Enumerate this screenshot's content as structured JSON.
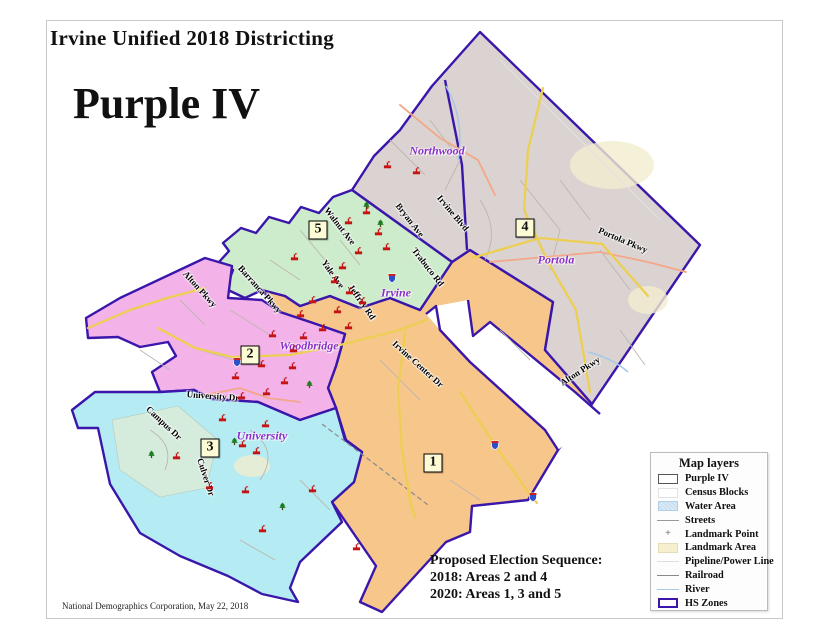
{
  "page": {
    "title": "Irvine Unified 2018 Districting",
    "map_name": "Purple IV",
    "footer": "National Demographics Corporation, May 22, 2018"
  },
  "election_sequence": {
    "heading": "Proposed Election Sequence:",
    "line1": "2018: Areas 2 and 4",
    "line2": "2020: Areas 1, 3 and 5"
  },
  "legend": {
    "title": "Map layers",
    "items": [
      {
        "label": "Purple IV",
        "swatch": "district-outline"
      },
      {
        "label": "Census Blocks",
        "swatch": "census-box"
      },
      {
        "label": "Water Area",
        "swatch": "water-box"
      },
      {
        "label": "Streets",
        "swatch": "street-line"
      },
      {
        "label": "Landmark Point",
        "swatch": "landmark-point",
        "symbol": "+"
      },
      {
        "label": "Landmark Area",
        "swatch": "landmark-box"
      },
      {
        "label": "Pipeline/Power Line",
        "swatch": "pipeline-line"
      },
      {
        "label": "Railroad",
        "swatch": "railroad-line"
      },
      {
        "label": "River",
        "swatch": "river-line"
      },
      {
        "label": "HS Zones",
        "swatch": "hszone-outline"
      }
    ]
  },
  "districts": {
    "area1": {
      "number": "1",
      "color": "#f7c68b",
      "badge": {
        "x": 433,
        "y": 463
      }
    },
    "area2": {
      "number": "2",
      "color": "#f3b3e9",
      "badge": {
        "x": 250,
        "y": 355
      }
    },
    "area3": {
      "number": "3",
      "color": "#b5ebf3",
      "badge": {
        "x": 210,
        "y": 448
      }
    },
    "area4": {
      "number": "4",
      "color": "#dbd3d1",
      "badge": {
        "x": 525,
        "y": 228
      }
    },
    "area5": {
      "number": "5",
      "color": "#cdeccb",
      "badge": {
        "x": 318,
        "y": 230
      }
    }
  },
  "place_labels": [
    {
      "text": "Northwood",
      "x": 437,
      "y": 151
    },
    {
      "text": "Portola",
      "x": 556,
      "y": 260
    },
    {
      "text": "Irvine",
      "x": 396,
      "y": 293
    },
    {
      "text": "Woodbridge",
      "x": 309,
      "y": 346
    },
    {
      "text": "University",
      "x": 262,
      "y": 436
    }
  ],
  "street_labels": [
    {
      "text": "Bryan Ave",
      "x": 410,
      "y": 220,
      "rot": 52
    },
    {
      "text": "Irvine Blvd",
      "x": 453,
      "y": 213,
      "rot": 50
    },
    {
      "text": "Trabuco Rd",
      "x": 428,
      "y": 267,
      "rot": 52
    },
    {
      "text": "Portola Pkwy",
      "x": 623,
      "y": 240,
      "rot": 23
    },
    {
      "text": "Walnut Ave",
      "x": 340,
      "y": 226,
      "rot": 52
    },
    {
      "text": "Yale Ave",
      "x": 333,
      "y": 274,
      "rot": 55
    },
    {
      "text": "Jeffrey Rd",
      "x": 362,
      "y": 302,
      "rot": 55
    },
    {
      "text": "Barranca Pkwy",
      "x": 260,
      "y": 289,
      "rot": 48
    },
    {
      "text": "Alton Pkwy",
      "x": 200,
      "y": 289,
      "rot": 48
    },
    {
      "text": "Alton Pkwy",
      "x": 580,
      "y": 371,
      "rot": -33
    },
    {
      "text": "University Dr",
      "x": 213,
      "y": 396,
      "rot": 4
    },
    {
      "text": "Campus Dr",
      "x": 164,
      "y": 423,
      "rot": 43
    },
    {
      "text": "Culver Dr",
      "x": 206,
      "y": 477,
      "rot": 72
    },
    {
      "text": "Irvine Center Dr",
      "x": 418,
      "y": 364,
      "rot": 42
    }
  ],
  "map_icons": {
    "schools": [
      [
        383,
        160
      ],
      [
        412,
        166
      ],
      [
        362,
        206
      ],
      [
        344,
        216
      ],
      [
        374,
        227
      ],
      [
        382,
        242
      ],
      [
        354,
        246
      ],
      [
        290,
        252
      ],
      [
        338,
        261
      ],
      [
        330,
        275
      ],
      [
        345,
        286
      ],
      [
        308,
        295
      ],
      [
        358,
        296
      ],
      [
        333,
        305
      ],
      [
        296,
        309
      ],
      [
        318,
        323
      ],
      [
        344,
        321
      ],
      [
        268,
        329
      ],
      [
        299,
        331
      ],
      [
        289,
        344
      ],
      [
        257,
        359
      ],
      [
        288,
        361
      ],
      [
        231,
        371
      ],
      [
        280,
        376
      ],
      [
        262,
        387
      ],
      [
        237,
        391
      ],
      [
        218,
        413
      ],
      [
        261,
        419
      ],
      [
        238,
        439
      ],
      [
        252,
        446
      ],
      [
        172,
        451
      ],
      [
        205,
        481
      ],
      [
        241,
        485
      ],
      [
        258,
        524
      ],
      [
        352,
        542
      ],
      [
        308,
        484
      ]
    ],
    "trees": [
      [
        362,
        201
      ],
      [
        376,
        219
      ],
      [
        305,
        380
      ],
      [
        147,
        450
      ],
      [
        278,
        502
      ],
      [
        230,
        437
      ]
    ],
    "shields": [
      [
        387,
        273
      ],
      [
        232,
        357
      ],
      [
        490,
        440
      ],
      [
        528,
        492
      ]
    ]
  },
  "colors": {
    "hs_zone_border": "#3a16aa",
    "badge_bg": "#fdfad6",
    "place_label": "#8b2fc9",
    "major_road": "#eccf52",
    "highway_secondary": "#f2a888",
    "river": "#a5c9e6"
  },
  "icons": {
    "school": "school-icon",
    "tree": "tree-icon",
    "interstate_shield": "interstate-shield-icon",
    "landmark_point": "+"
  }
}
